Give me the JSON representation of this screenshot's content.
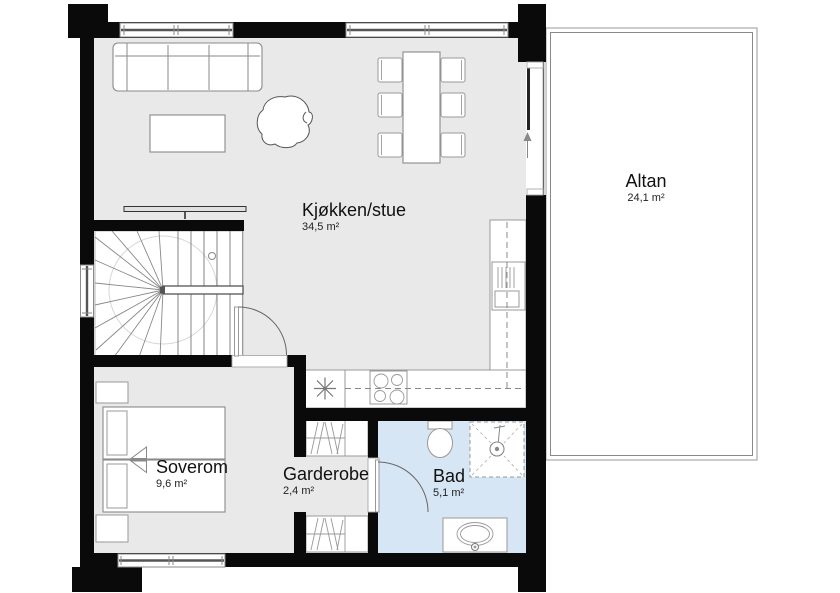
{
  "plan": {
    "rooms": {
      "kitchen_living": {
        "name": "Kjøkken/stue",
        "area": "34,5 m²"
      },
      "balcony": {
        "name": "Altan",
        "area": "24,1 m²"
      },
      "bedroom": {
        "name": "Soverom",
        "area": "9,6 m²"
      },
      "wardrobe": {
        "name": "Garderobe",
        "area": "2,4 m²"
      },
      "bathroom": {
        "name": "Bad",
        "area": "5,1 m²"
      }
    },
    "symbols": {
      "appliance_star": "✳",
      "slide_direction_arrow": "↑"
    },
    "colors": {
      "wall": "#0a0a0a",
      "floor": "#e9e9e9",
      "bath_floor": "#d7e6f4",
      "page_bg": "#ffffff",
      "line": "#8a8a8a"
    }
  }
}
